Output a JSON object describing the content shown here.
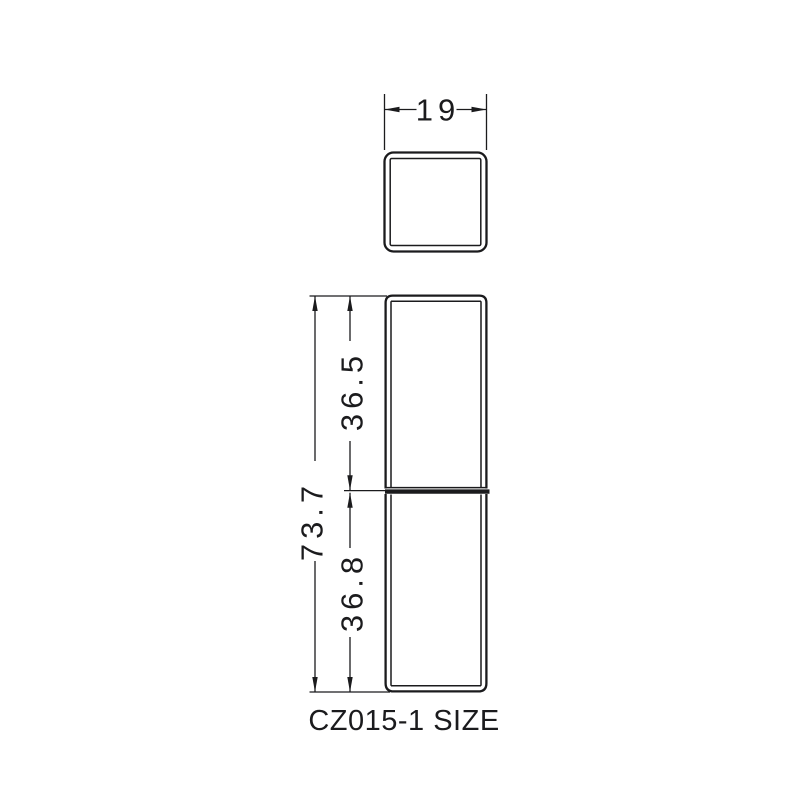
{
  "drawing": {
    "title": "CZ015-1 SIZE",
    "dimensions": {
      "width": "19",
      "total_height": "73.7",
      "upper_section_height": "36.5",
      "lower_section_height": "36.8"
    },
    "colors": {
      "line": "#1b1b1d",
      "background": "#ffffff"
    }
  }
}
